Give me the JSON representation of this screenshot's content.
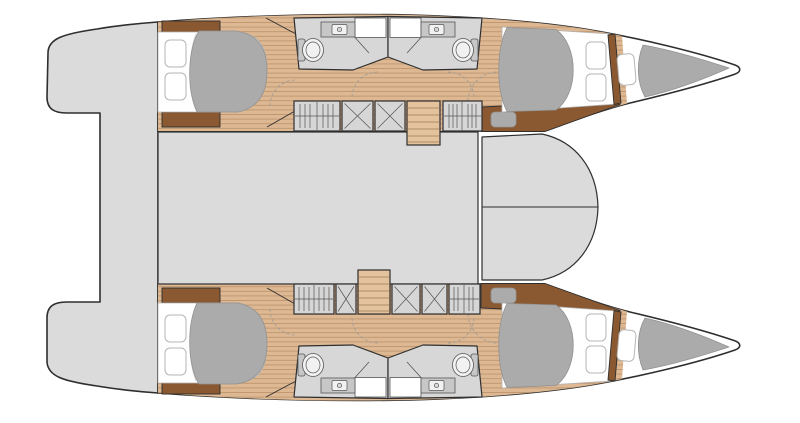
{
  "meta": {
    "title": "Catamaran interior layout plan",
    "description": "Overhead deck/accommodation plan of a sailing catamaran, 4 double cabins and 4 bathrooms",
    "view": "top-down",
    "orientation": {
      "bow": "right",
      "stern": "left",
      "top_hull": "port",
      "bottom_hull": "starboard"
    }
  },
  "areas": {
    "salon": "salon-bridgedeck",
    "forward_cockpit": "forward-cockpit-seats",
    "aft_structure": "aft-platform-and-transoms",
    "port_hull": "port-hull",
    "starboard_hull": "starboard-hull",
    "aft_cabin": "aft-double-cabin",
    "forward_cabin": "forward-double-cabin",
    "bow_compartment": "bow-berth-locker",
    "bathroom": "bathroom-with-shower-toilet-sink",
    "wardrobe": "hanging-wardrobe",
    "storage": "storage-locker",
    "stairs": "companionway-steps",
    "desk": "forward-cabin-desk",
    "counts": {
      "cabins": 4,
      "bathrooms": 4,
      "hulls": 2
    }
  },
  "palette": {
    "background": "#ffffff",
    "outline": "#2e2e2e",
    "hull_white": "#ffffff",
    "deck_gray": "#dbdbdb",
    "bathroom_gray": "#d7d7d7",
    "cabinet_gray": "#d6d6d6",
    "counter_gray": "#c7c7c7",
    "fixture_white": "#f1f1f1",
    "wood": "#ddb893",
    "wood_stairs": "#e4c29c",
    "wood_trim": "#8a5931",
    "soft_gray": "#ababab",
    "soft_edge": "#929292",
    "pillow_edge": "#b5b5b5",
    "fold_line": "#cfcfcf",
    "dash_line": "#9a9a9a",
    "plank_line": "#92673e",
    "tread_line": "#8a6a45",
    "detail": "#555555"
  }
}
